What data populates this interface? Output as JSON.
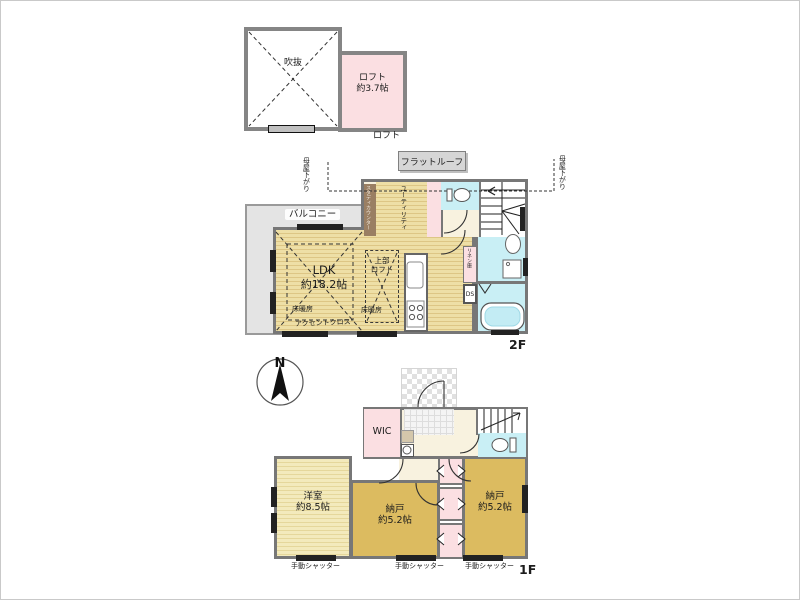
{
  "loft": {
    "void_label": "吹抜",
    "room_name": "ロフト",
    "room_size": "約3.7帖",
    "floor_label": "ロフト"
  },
  "f2": {
    "flat_roof": "フラットルーフ",
    "moya_left": "母屋下がり",
    "moya_right": "母屋下がり",
    "balcony": "バルコニー",
    "study_counter": "スタディカウンター",
    "utility": "ユーティリティ",
    "ldk_name": "LDK",
    "ldk_size": "約18.2帖",
    "upper_loft_line1": "上部",
    "upper_loft_line2": "ロフト",
    "floor_heating_a": "床暖房",
    "floor_heating_b": "床暖房",
    "accent_cross": "アクセントクロス",
    "linen": "リネン庫",
    "ds": "DS",
    "floor_label": "2F"
  },
  "f1": {
    "compass_n": "N",
    "wic": "WIC",
    "western_name": "洋室",
    "western_size": "約8.5帖",
    "storage_mid_name": "納戸",
    "storage_mid_size": "約5.2帖",
    "storage_right_name": "納戸",
    "storage_right_size": "約5.2帖",
    "shutters": [
      "手動シャッター",
      "手動シャッター",
      "手動シャッター"
    ],
    "floor_label": "1F"
  },
  "colors": {
    "wall": "#777777",
    "wood_2f": "#eedfa6",
    "wood_1f": "#f3eabc",
    "storage_tan": "#dcbb60",
    "closet_pink": "#fbdfe2",
    "water_blue": "#c9eff5",
    "balcony_gray": "#e4e4e4",
    "entrance_cream": "#f8f2df",
    "counter_brown": "#9a7f63"
  }
}
